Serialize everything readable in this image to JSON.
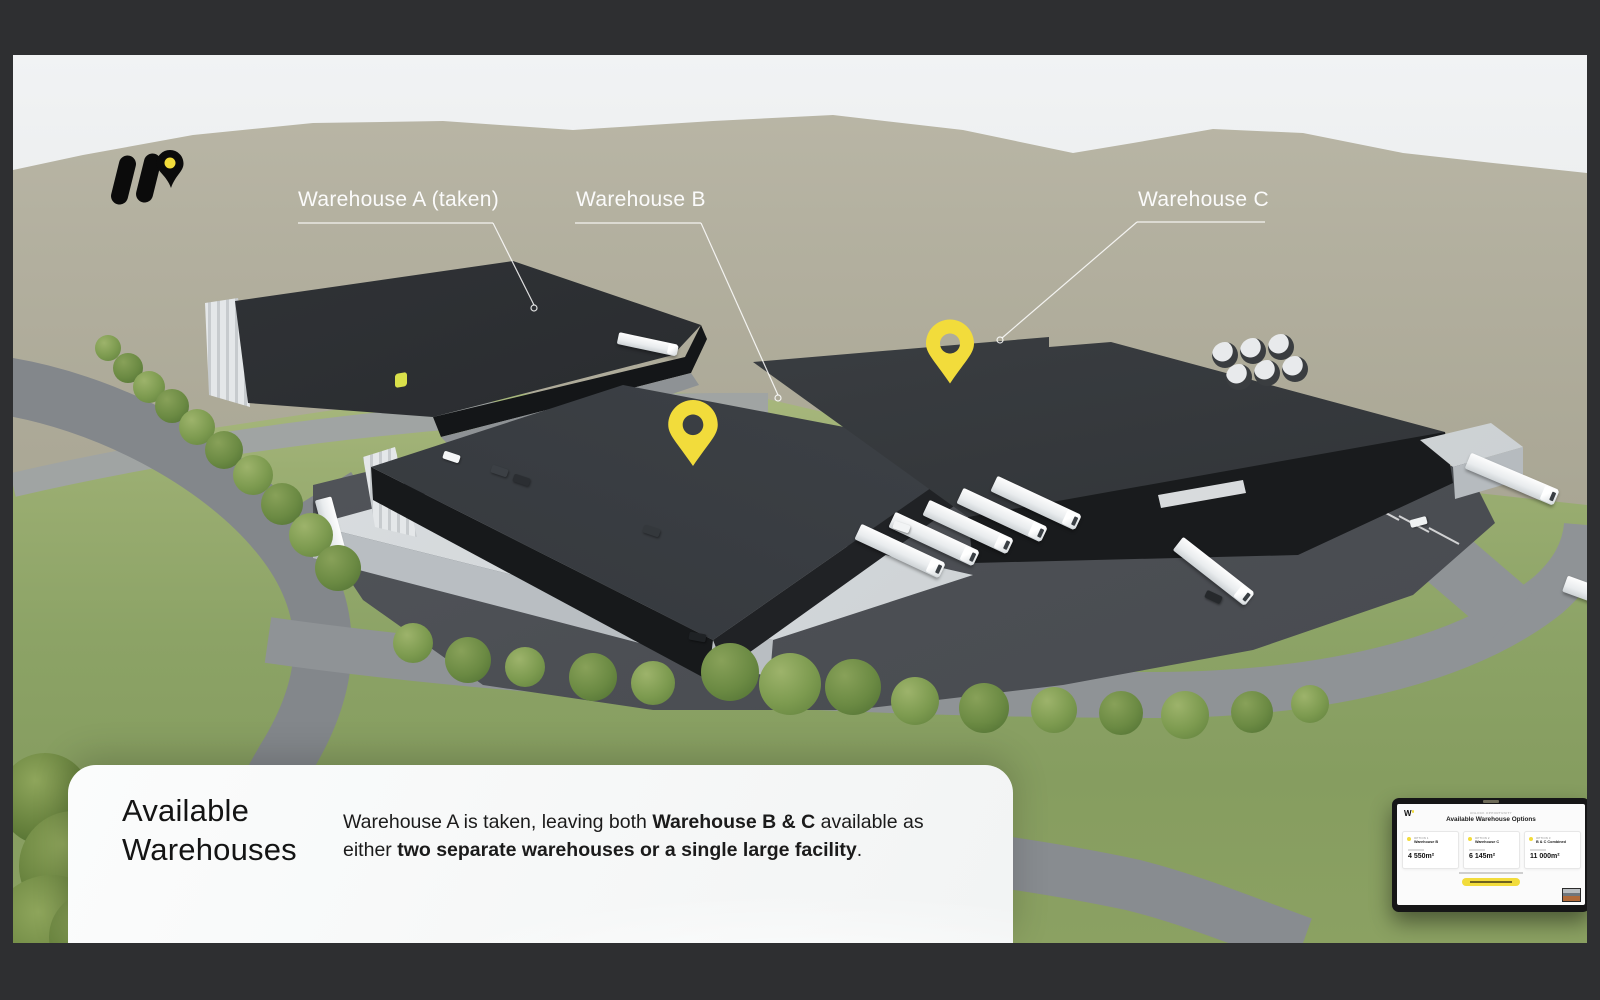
{
  "window": {
    "frame_color": "#2E2F31"
  },
  "slide": {
    "annotations": {
      "warehouse_a_label": "Warehouse A (taken)",
      "warehouse_b_label": "Warehouse B",
      "warehouse_c_label": "Warehouse C"
    },
    "panel": {
      "title_line1": "Available",
      "title_line2": "Warehouses",
      "body_segments": [
        {
          "text": "Warehouse A is taken, leaving both "
        },
        {
          "text": "Warehouse B & C"
        },
        {
          "text": " available as either "
        },
        {
          "text": "two separate warehouses or a single large facility"
        },
        {
          "text": "."
        }
      ]
    },
    "tablet": {
      "logo_text": "W",
      "eyebrow": "UNLOCK OPPORTUNITY",
      "heading": "Available Warehouse Options",
      "options": [
        {
          "tag": "OPTION 1",
          "name": "Warehouse B",
          "value": "4 550m²"
        },
        {
          "tag": "OPTION 2",
          "name": "Warehouse C",
          "value": "6 145m²"
        },
        {
          "tag": "OPTION 3",
          "name": "B & C Combined",
          "value": "11 000m²"
        }
      ]
    },
    "colors": {
      "pin_yellow": "#F2DC3B",
      "label_white": "#FBFBFB",
      "roof_dark": "#2F3236",
      "grass_green": "#8CA366",
      "hill_olive": "#B2AF9E"
    }
  }
}
